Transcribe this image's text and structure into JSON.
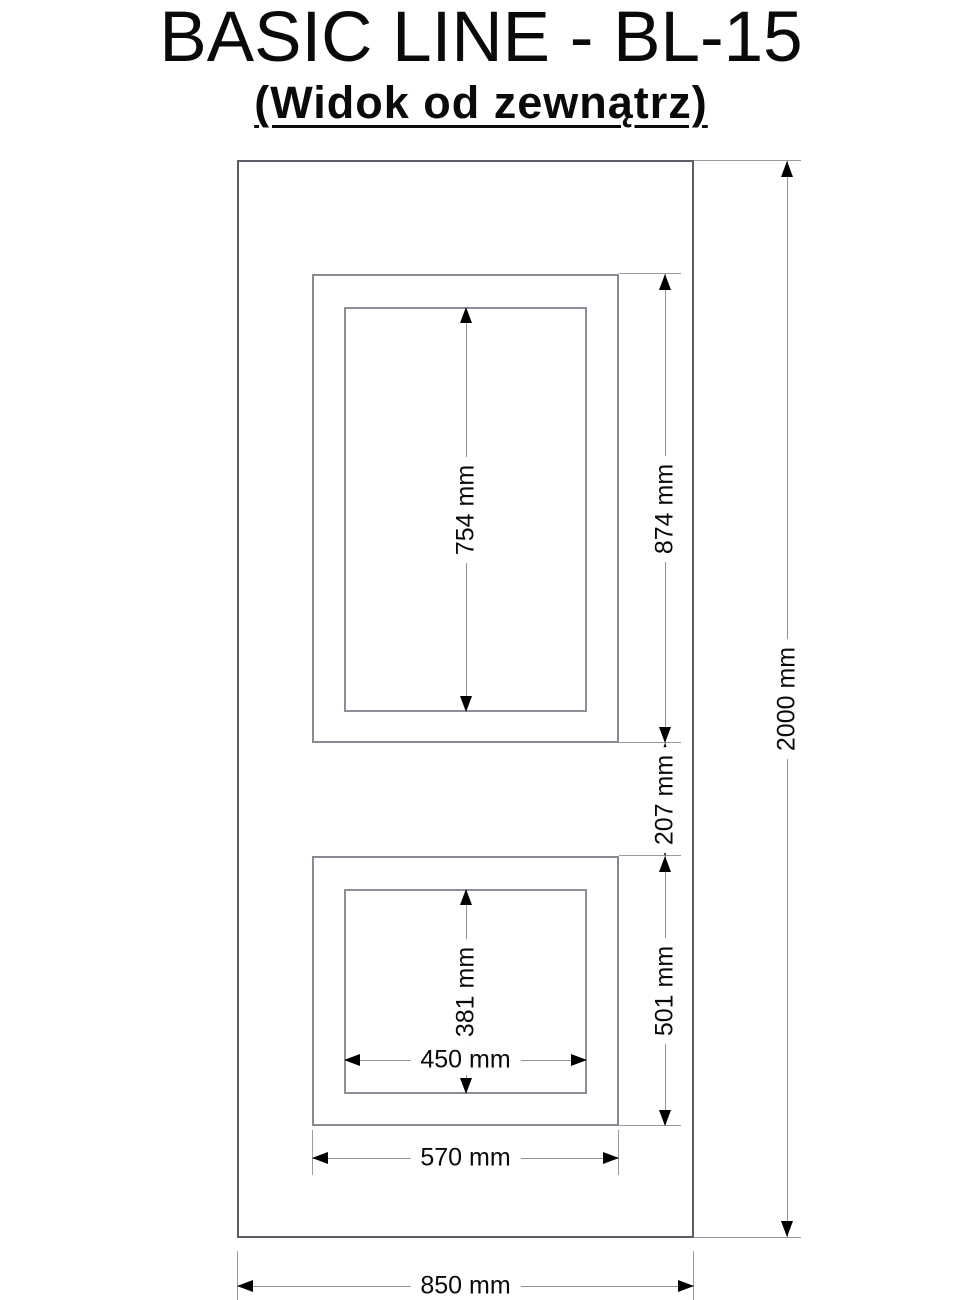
{
  "header": {
    "title": "BASIC LINE - BL-15",
    "subtitle": "(Widok od zewnątrz)"
  },
  "dims": {
    "upper_glass_height": "754 mm",
    "upper_frame_height": "874 mm",
    "gap_between_windows": "207 mm",
    "lower_frame_height": "501 mm",
    "lower_glass_height": "381 mm",
    "lower_glass_width": "450 mm",
    "lower_frame_width": "570 mm",
    "door_height": "2000 mm",
    "door_width": "850 mm"
  },
  "colors": {
    "background": "#ffffff",
    "text": "#000000",
    "door_line": "#5d5d68",
    "frame_line": "#898993",
    "dimension_line": "#90909a",
    "arrow": "#000000"
  }
}
